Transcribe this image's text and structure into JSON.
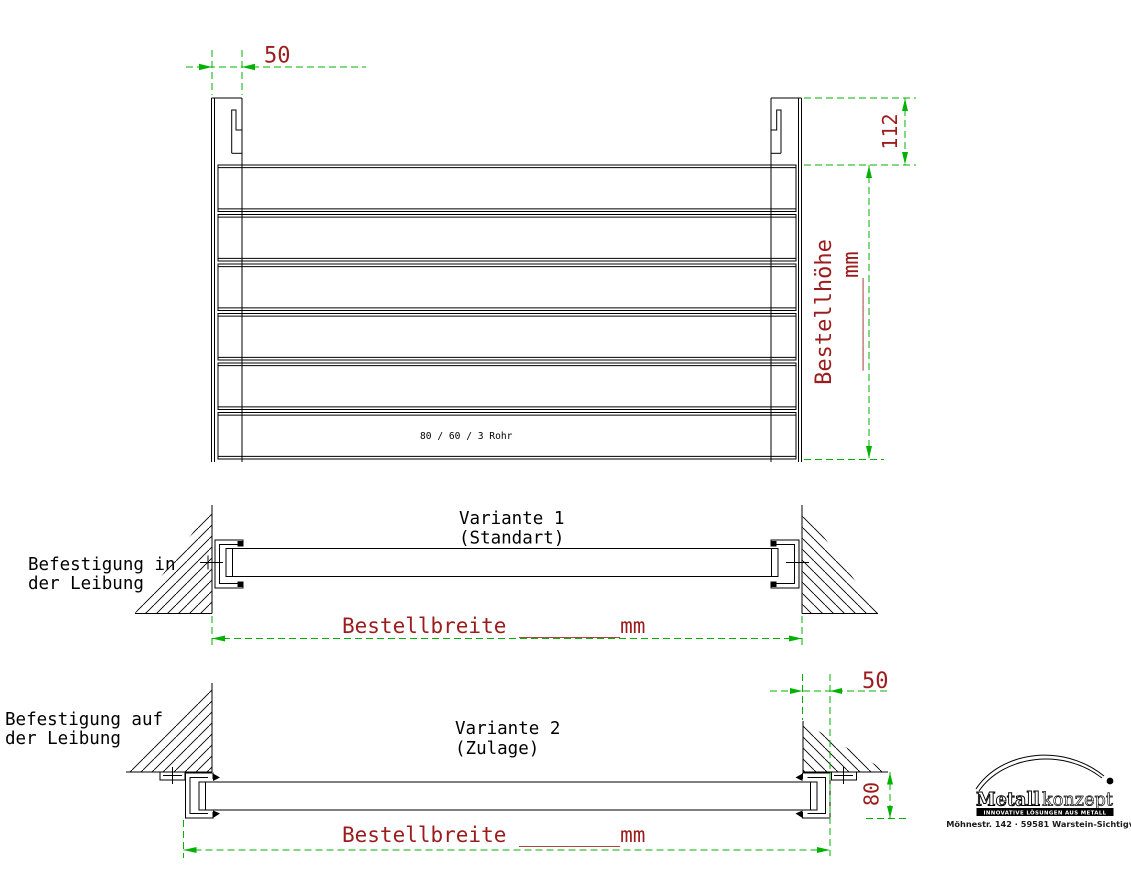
{
  "front_view": {
    "dim_post_offset": "50",
    "dim_top_height": "112",
    "height_dim_label": "Bestellhöhe",
    "height_dim_blank": "_______mm",
    "tube_spec": "80 / 60 / 3 Rohr"
  },
  "variant1": {
    "title": "Variante 1",
    "subtitle": "(Standart)",
    "mount_line1": "Befestigung in",
    "mount_line2": "der Leibung",
    "width_dim": "Bestellbreite ________mm"
  },
  "variant2": {
    "title": "Variante 2",
    "subtitle": "(Zulage)",
    "mount_line1": "Befestigung auf",
    "mount_line2": "der Leibung",
    "dim_wall_offset": "50",
    "dim_mount_height": "80",
    "width_dim": "Bestellbreite ________mm"
  },
  "logo": {
    "brand_part1": "Metall",
    "brand_part2": "konzept",
    "tagline": "INNOVATIVE LÖSUNGEN AUS METALL",
    "address": "Möhnestr. 142 · 59581 Warstein-Sichtigvor"
  },
  "colors": {
    "outline": "#000000",
    "dimension_line": "#00b200",
    "dimension_text": "#9b1c1c"
  }
}
